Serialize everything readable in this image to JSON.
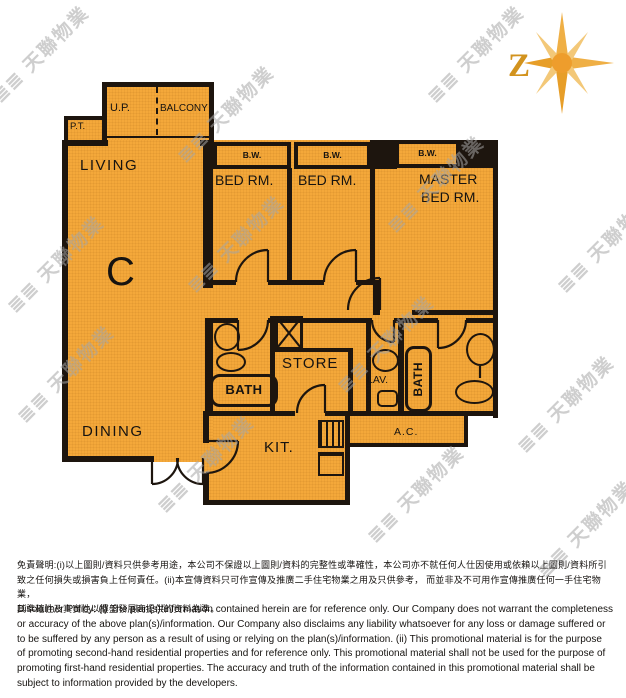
{
  "unit": {
    "label": "C"
  },
  "compass": {
    "label": "Z"
  },
  "rooms": {
    "living": "LIVING",
    "dining": "DINING",
    "up": "U.P.",
    "balcony": "BALCONY",
    "pt": "P.T.",
    "bw": "B.W.",
    "bed": "BED RM.",
    "master_line1": "MASTER",
    "master_line2": "BED RM.",
    "bath": "BATH",
    "store": "STORE",
    "lav": "LAV.",
    "pd": "P.D.",
    "kit": "KIT.",
    "ac": "A.C."
  },
  "watermark": {
    "logo": "≣≣",
    "text": "天聯物業"
  },
  "colors": {
    "floor": "#F4A83A",
    "wall": "#1d150e",
    "compass_gold": "#EFAF45"
  },
  "disclaimer": {
    "zh_lines": [
      "免責聲明:(i)以上圖則/資料只供參考用途，本公司不保證以上圖則/資料的完整性或準確性，本公司亦不就任何人仕因使用或依賴以上圖則/資料所引",
      "致之任何損失或損害負上任何責任。(ii)本宣傳資料只可作宣傳及推廣二手住宅物業之用及只供參考， 而並非及不可用作宣傳推廣任何一手住宅物業，",
      "其準確性及真實性以樓盤發展商提供的資料為準。"
    ],
    "en": "Disclaimer Policy: (i) The plan(s)/information contained herein are for reference only. Our Company does not warrant the completeness or accuracy of the above plan(s)/information. Our Company also disclaims any liability whatsoever for any loss or damage suffered or to be suffered by any person as a result of using or relying on the plan(s)/information. (ii) This promotional material is for the purpose of promoting second-hand residential properties and for reference only. This promotional material shall not be used for the purpose of promoting first-hand residential properties. The accuracy and truth of the information contained in this promotional material shall be subject to information provided by the developers."
  }
}
